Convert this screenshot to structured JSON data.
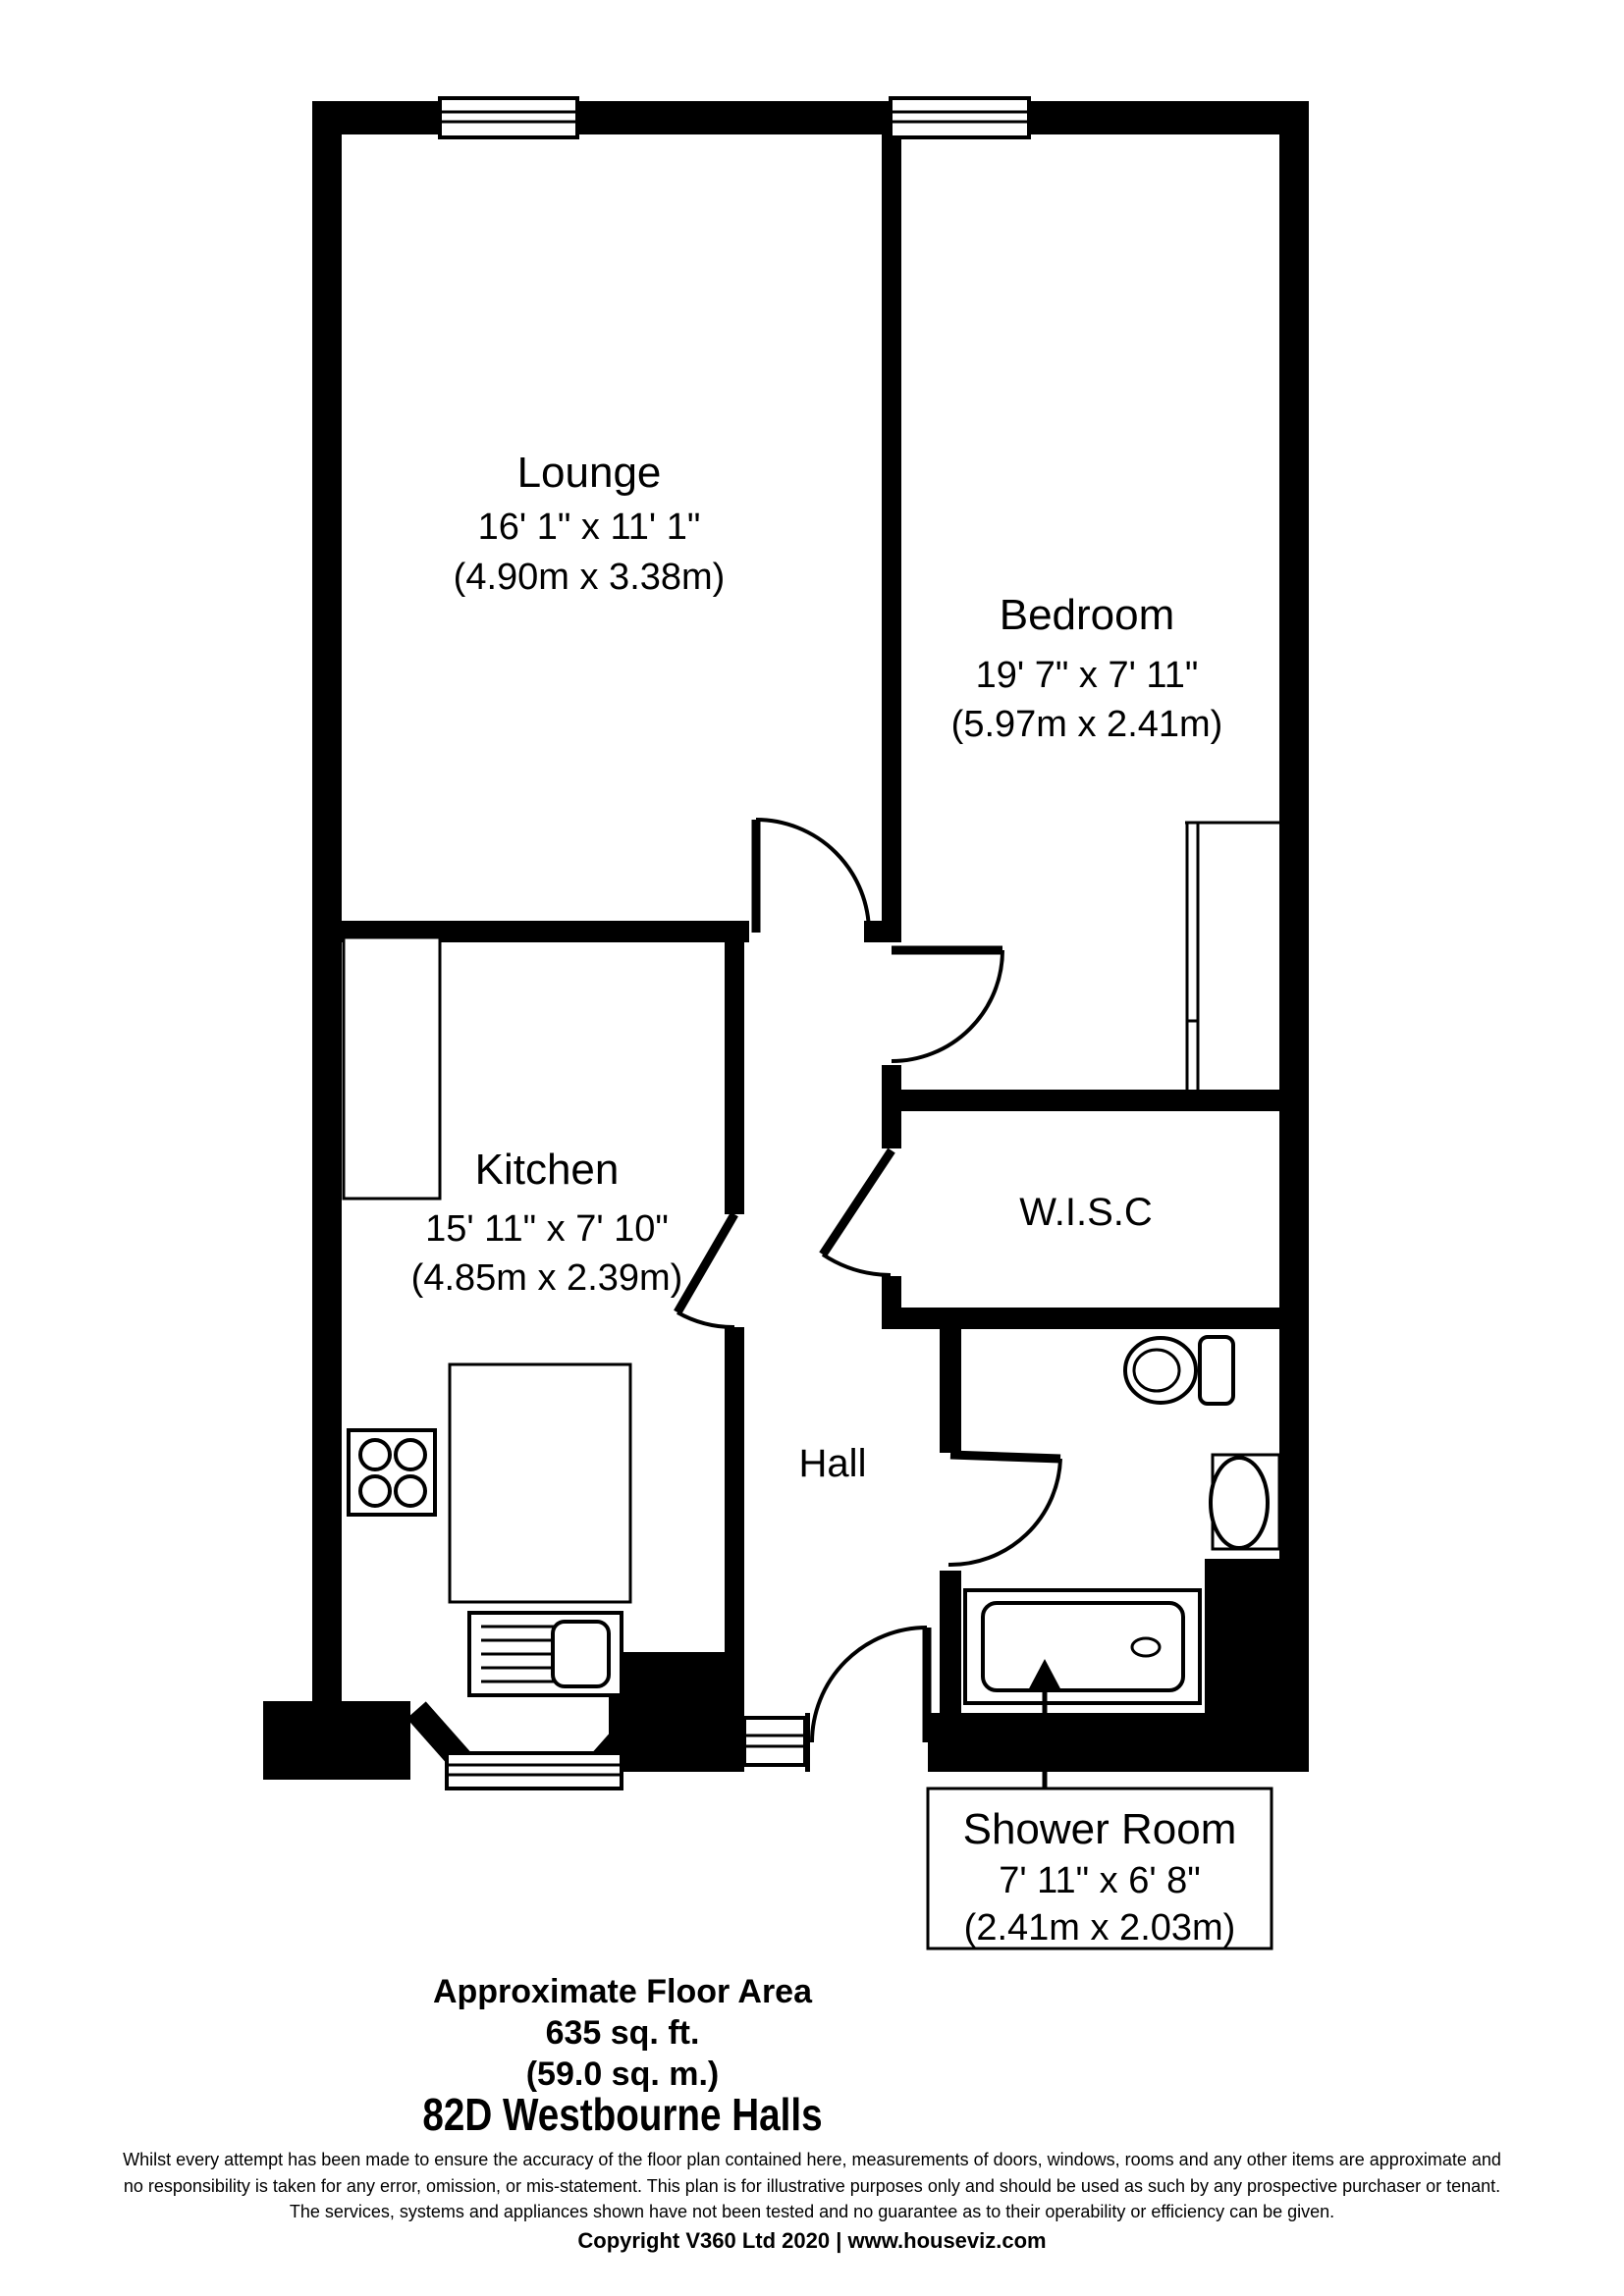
{
  "plan": {
    "rooms": {
      "lounge": {
        "name": "Lounge",
        "dim_ft": "16' 1\" x 11' 1\"",
        "dim_m": "(4.90m x 3.38m)"
      },
      "bedroom": {
        "name": "Bedroom",
        "dim_ft": "19' 7\" x 7' 11\"",
        "dim_m": "(5.97m x 2.41m)"
      },
      "kitchen": {
        "name": "Kitchen",
        "dim_ft": "15' 11\" x 7' 10\"",
        "dim_m": "(4.85m x 2.39m)"
      },
      "wisc": {
        "name": "W.I.S.C"
      },
      "hall": {
        "name": "Hall"
      },
      "shower": {
        "name": "Shower Room",
        "dim_ft": "7' 11\" x 6' 8\"",
        "dim_m": "(2.41m x 2.03m)"
      }
    },
    "fixtures": [
      "window",
      "door-swing",
      "toilet",
      "basin",
      "shower-tray",
      "hob-four-ring",
      "kitchen-sink",
      "counter",
      "built-in-wardrobe"
    ],
    "colors": {
      "wall": "#000000",
      "background": "#ffffff",
      "line": "#000000"
    }
  },
  "footer": {
    "area_title": "Approximate Floor Area",
    "area_sqft": "635 sq. ft.",
    "area_sqm": "(59.0 sq. m.)",
    "address": "82D Westbourne Halls"
  },
  "disclaimer": {
    "line1": "Whilst every attempt has been made to ensure the accuracy of the floor plan contained here, measurements of doors, windows, rooms and any other items are approximate and",
    "line2": "no responsibility is taken for any error, omission, or mis-statement. This plan is for illustrative purposes only and should be used as such by any prospective purchaser or tenant.",
    "line3": "The services, systems and appliances shown have not been tested and no guarantee as to their operability or efficiency can be given.",
    "copyright": "Copyright V360 Ltd 2020 | www.houseviz.com"
  }
}
